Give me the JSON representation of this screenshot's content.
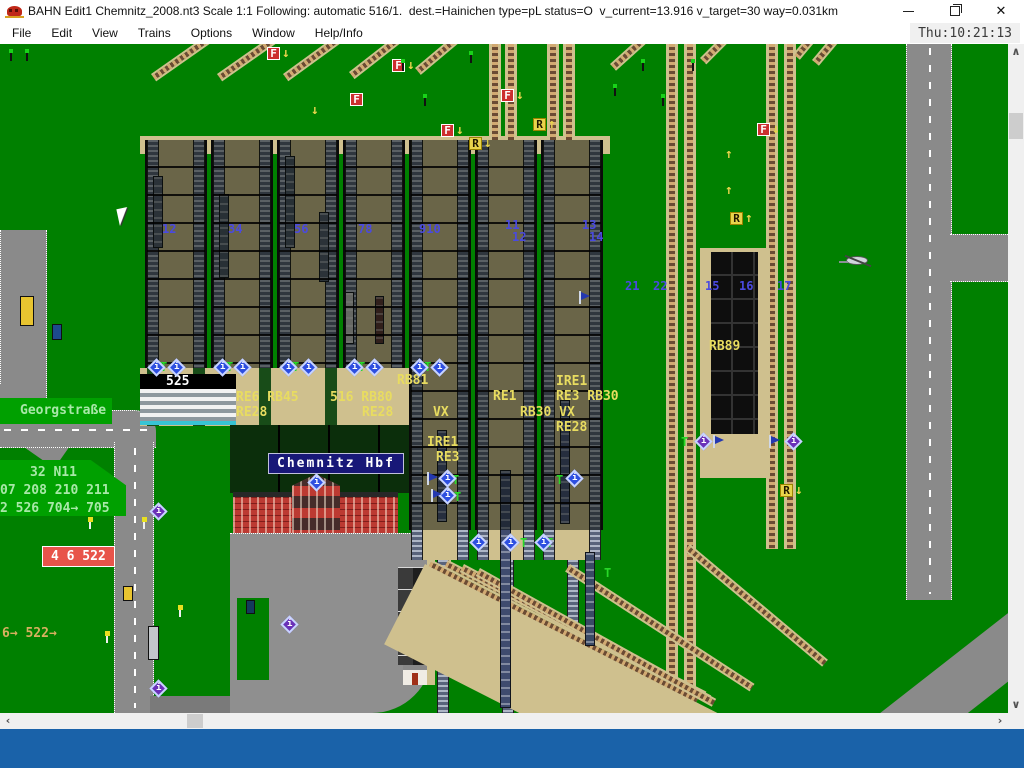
{
  "window": {
    "title": "BAHN Edit1 Chemnitz_2008.nt3 Scale 1:1 Following: automatic 516/1.  dest.=Hainichen type=pL status=O  v_current=13.916 v_target=30 way=0.031km",
    "close_glyph": "✕"
  },
  "menu": {
    "items": [
      "File",
      "Edit",
      "View",
      "Trains",
      "Options",
      "Window",
      "Help/Info"
    ],
    "clock": "Thu:10:21:13"
  },
  "colors": {
    "canvas_green": "#008000",
    "label_patch_green": "#00a000",
    "label_yellow": "#e8dc60",
    "label_green": "#a8e8a8",
    "label_tan": "#d8b060",
    "platform_tan": "#cfc08e",
    "taskbar_blue": "#1a62a9",
    "badge_red": "#e8544a",
    "station_label_navy": "#181878"
  },
  "icons": {
    "info_glyph": "i"
  },
  "canvas": {
    "station_label": {
      "text": "Chemnitz Hbf"
    },
    "badge": {
      "text": "4 6 522"
    },
    "route_labels": [
      {
        "t": "525",
        "x": 166,
        "y": 331,
        "c": "white"
      },
      {
        "t": "RE6 RB45",
        "x": 236,
        "y": 347,
        "c": "yellow"
      },
      {
        "t": "RE28",
        "x": 236,
        "y": 362,
        "c": "yellow"
      },
      {
        "t": "516 RB80",
        "x": 330,
        "y": 347,
        "c": "yellow"
      },
      {
        "t": "RE28",
        "x": 362,
        "y": 362,
        "c": "yellow"
      },
      {
        "t": "RB81",
        "x": 397,
        "y": 330,
        "c": "yellow"
      },
      {
        "t": "RE1",
        "x": 493,
        "y": 346,
        "c": "yellow"
      },
      {
        "t": "IRE1",
        "x": 556,
        "y": 331,
        "c": "yellow"
      },
      {
        "t": "RE3 RB30",
        "x": 556,
        "y": 346,
        "c": "yellow"
      },
      {
        "t": "VX",
        "x": 433,
        "y": 362,
        "c": "yellow"
      },
      {
        "t": "RB30 VX",
        "x": 520,
        "y": 362,
        "c": "yellow"
      },
      {
        "t": "RE28",
        "x": 556,
        "y": 377,
        "c": "yellow"
      },
      {
        "t": "IRE1",
        "x": 427,
        "y": 392,
        "c": "yellow"
      },
      {
        "t": "RE3",
        "x": 436,
        "y": 407,
        "c": "yellow"
      },
      {
        "t": "RB89",
        "x": 709,
        "y": 296,
        "c": "yellow"
      },
      {
        "t": "Georgstraße",
        "x": 20,
        "y": 360,
        "c": "green"
      },
      {
        "t": "32 N11",
        "x": 30,
        "y": 422,
        "c": "green"
      },
      {
        "t": "07 208 210 211",
        "x": 0,
        "y": 440,
        "c": "green"
      },
      {
        "t": "2 526 704→ 705",
        "x": 0,
        "y": 458,
        "c": "green"
      },
      {
        "t": "6→ 522→",
        "x": 2,
        "y": 583,
        "c": "tan"
      }
    ],
    "platform_numbers": [
      {
        "t": "12",
        "x": 162,
        "y": 179
      },
      {
        "t": "34",
        "x": 228,
        "y": 179
      },
      {
        "t": "56",
        "x": 294,
        "y": 179
      },
      {
        "t": "78",
        "x": 358,
        "y": 179
      },
      {
        "t": "910",
        "x": 419,
        "y": 179
      },
      {
        "t": "11",
        "x": 505,
        "y": 175
      },
      {
        "t": "12",
        "x": 512,
        "y": 187
      },
      {
        "t": "13",
        "x": 582,
        "y": 175
      },
      {
        "t": "14",
        "x": 589,
        "y": 187
      },
      {
        "t": "21",
        "x": 625,
        "y": 236
      },
      {
        "t": "22",
        "x": 653,
        "y": 236
      },
      {
        "t": "15",
        "x": 705,
        "y": 236
      },
      {
        "t": "16",
        "x": 739,
        "y": 236
      },
      {
        "t": "17",
        "x": 777,
        "y": 236
      }
    ],
    "signal_markers": [
      {
        "k": "F",
        "x": 441,
        "y": 80,
        "a": "↓"
      },
      {
        "k": "R",
        "x": 469,
        "y": 93,
        "a": "↓"
      },
      {
        "k": "F",
        "x": 501,
        "y": 45,
        "a": "↓"
      },
      {
        "k": "R",
        "x": 533,
        "y": 74,
        "a": "↑"
      },
      {
        "k": "F",
        "x": 350,
        "y": 49,
        "a": ""
      },
      {
        "k": "F",
        "x": 267,
        "y": 3,
        "a": "↓"
      },
      {
        "k": "F",
        "x": 392,
        "y": 15,
        "a": "↓"
      },
      {
        "k": "F",
        "x": 757,
        "y": 79,
        "a": "↓"
      },
      {
        "k": "R",
        "x": 730,
        "y": 168,
        "a": "↑"
      },
      {
        "k": "R",
        "x": 780,
        "y": 440,
        "a": "↓"
      },
      {
        "k": "",
        "x": 710,
        "y": 104,
        "a": "↑"
      },
      {
        "k": "",
        "x": 710,
        "y": 140,
        "a": "↑"
      },
      {
        "k": "",
        "x": 296,
        "y": 60,
        "a": "↓"
      }
    ],
    "t_letters": [
      {
        "x": 160,
        "y": 317
      },
      {
        "x": 226,
        "y": 317
      },
      {
        "x": 292,
        "y": 317
      },
      {
        "x": 358,
        "y": 317
      },
      {
        "x": 424,
        "y": 317
      },
      {
        "x": 452,
        "y": 430
      },
      {
        "x": 454,
        "y": 447
      },
      {
        "x": 556,
        "y": 430
      },
      {
        "x": 520,
        "y": 493
      },
      {
        "x": 546,
        "y": 493
      },
      {
        "x": 681,
        "y": 392
      },
      {
        "x": 604,
        "y": 523
      }
    ],
    "info_signals": [
      {
        "x": 150,
        "y": 317,
        "p": 0
      },
      {
        "x": 170,
        "y": 317,
        "p": 0
      },
      {
        "x": 216,
        "y": 317,
        "p": 0
      },
      {
        "x": 236,
        "y": 317,
        "p": 0
      },
      {
        "x": 282,
        "y": 317,
        "p": 0
      },
      {
        "x": 302,
        "y": 317,
        "p": 0
      },
      {
        "x": 348,
        "y": 317,
        "p": 0
      },
      {
        "x": 368,
        "y": 317,
        "p": 0
      },
      {
        "x": 413,
        "y": 317,
        "p": 0
      },
      {
        "x": 433,
        "y": 317,
        "p": 0
      },
      {
        "x": 441,
        "y": 428,
        "p": 0
      },
      {
        "x": 441,
        "y": 445,
        "p": 0
      },
      {
        "x": 568,
        "y": 428,
        "p": 0
      },
      {
        "x": 472,
        "y": 492,
        "p": 0
      },
      {
        "x": 504,
        "y": 492,
        "p": 0
      },
      {
        "x": 537,
        "y": 492,
        "p": 0
      },
      {
        "x": 310,
        "y": 432,
        "p": 0
      },
      {
        "x": 152,
        "y": 461,
        "p": 1
      },
      {
        "x": 283,
        "y": 574,
        "p": 1
      },
      {
        "x": 152,
        "y": 638,
        "p": 1
      },
      {
        "x": 697,
        "y": 391,
        "p": 1
      },
      {
        "x": 787,
        "y": 391,
        "p": 1
      }
    ],
    "flags": [
      {
        "x": 427,
        "y": 428
      },
      {
        "x": 431,
        "y": 445
      },
      {
        "x": 579,
        "y": 247
      },
      {
        "x": 713,
        "y": 391
      },
      {
        "x": 769,
        "y": 391
      }
    ],
    "signal_poles": [
      {
        "x": 8,
        "y": 5
      },
      {
        "x": 24,
        "y": 5
      },
      {
        "x": 400,
        "y": 15
      },
      {
        "x": 422,
        "y": 50
      },
      {
        "x": 468,
        "y": 7
      },
      {
        "x": 612,
        "y": 40
      },
      {
        "x": 640,
        "y": 15
      },
      {
        "x": 660,
        "y": 50
      },
      {
        "x": 690,
        "y": 15
      }
    ],
    "trains": [
      {
        "x": 437,
        "y": 386,
        "w": 10,
        "h": 92,
        "c": "#46537a"
      },
      {
        "x": 500,
        "y": 426,
        "w": 11,
        "h": 238,
        "c": "#3f4b6e"
      },
      {
        "x": 560,
        "y": 356,
        "w": 10,
        "h": 124,
        "c": "#46537a"
      },
      {
        "x": 585,
        "y": 508,
        "w": 10,
        "h": 94,
        "c": "#3a4a66"
      },
      {
        "x": 345,
        "y": 248,
        "w": 9,
        "h": 52,
        "c": "#c6c6c6"
      },
      {
        "x": 375,
        "y": 252,
        "w": 9,
        "h": 48,
        "c": "#5a3434"
      },
      {
        "x": 219,
        "y": 150,
        "w": 10,
        "h": 84,
        "c": "#4a5668"
      },
      {
        "x": 285,
        "y": 112,
        "w": 10,
        "h": 92,
        "c": "#4a5668"
      },
      {
        "x": 153,
        "y": 132,
        "w": 10,
        "h": 72,
        "c": "#505a6e"
      },
      {
        "x": 319,
        "y": 168,
        "w": 10,
        "h": 70,
        "c": "#505a6e"
      }
    ],
    "vehicles": [
      {
        "x": 20,
        "y": 252,
        "w": 14,
        "h": 30,
        "c": "#e8c430"
      },
      {
        "x": 52,
        "y": 280,
        "w": 10,
        "h": 16,
        "c": "#1d4a8c"
      },
      {
        "x": 123,
        "y": 542,
        "w": 10,
        "h": 15,
        "c": "#e8c430"
      },
      {
        "x": 148,
        "y": 582,
        "w": 11,
        "h": 34,
        "c": "#c2c6ca"
      },
      {
        "x": 246,
        "y": 556,
        "w": 9,
        "h": 14,
        "c": "#143a5c"
      }
    ],
    "bus_stops": [
      {
        "x": 87,
        "y": 473
      },
      {
        "x": 141,
        "y": 473
      },
      {
        "x": 104,
        "y": 587
      },
      {
        "x": 177,
        "y": 561
      }
    ]
  },
  "scrollbars": {
    "h": {
      "left": "‹",
      "right": "›"
    },
    "v": {
      "up": "∧",
      "down": "∨"
    }
  }
}
